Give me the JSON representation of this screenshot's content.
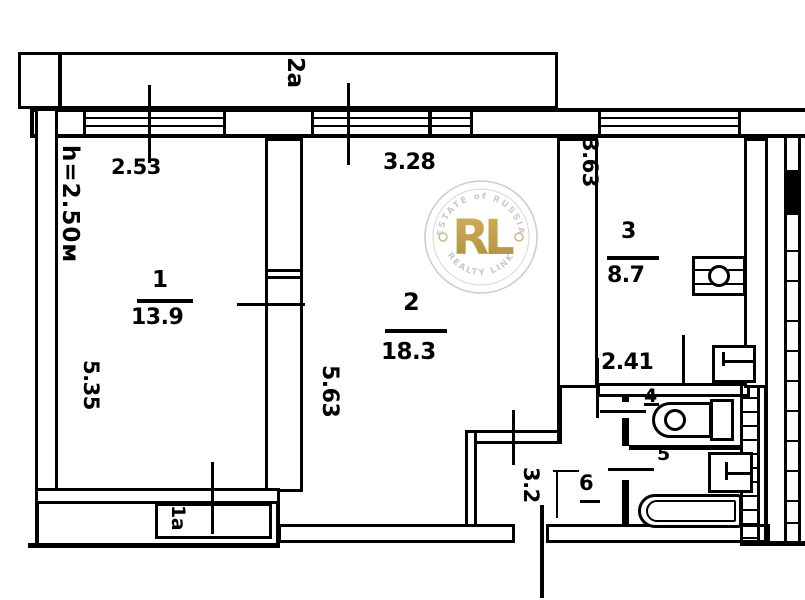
{
  "title": "apartment-floor-plan",
  "rooms": [
    {
      "number": "1",
      "area": "13.9",
      "width": "2.53",
      "height": "5.35"
    },
    {
      "number": "2",
      "area": "18.3",
      "width": "3.28",
      "height": "5.63"
    },
    {
      "number": "3",
      "area": "8.7",
      "width": "2.41",
      "height": "3.63"
    },
    {
      "number": "4"
    },
    {
      "number": "5"
    },
    {
      "number": "6",
      "area": "3.2"
    }
  ],
  "annotations": {
    "ceiling_height": "h=2.50м",
    "balcony_top": "2a",
    "balcony_bottom": "1a"
  },
  "watermark": {
    "monogram": "RL",
    "arc_top": "ESTATE of RUSSIA",
    "arc_bottom": "REALTY LINK",
    "gold": "#bd9a3c",
    "gray": "#c6c6c6"
  },
  "colors": {
    "ink": "#000000",
    "paper": "#ffffff"
  }
}
